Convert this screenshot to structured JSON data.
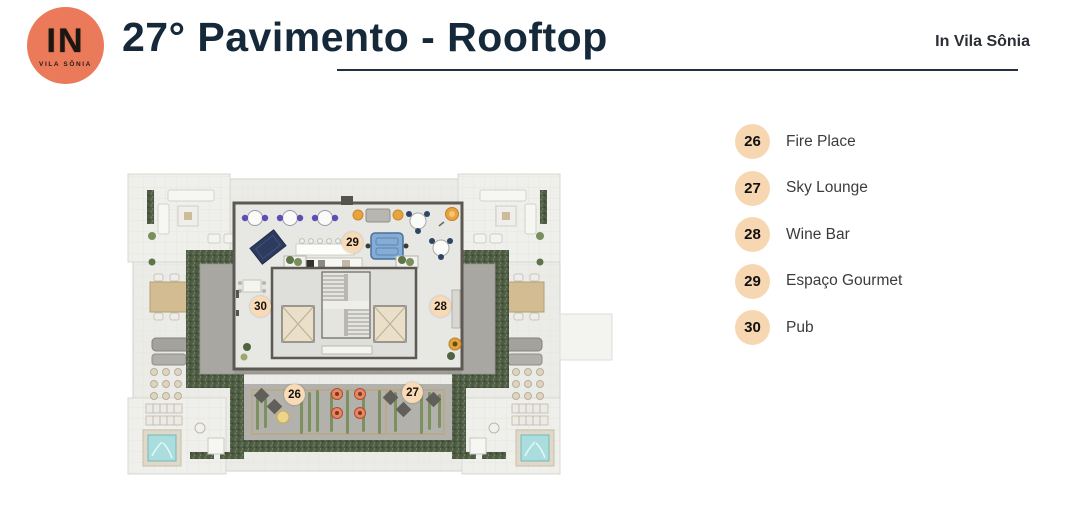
{
  "brand": {
    "logo_text": "IN",
    "logo_subtext": "VILA SÔNIA"
  },
  "header": {
    "title": "27° Pavimento - Rooftop",
    "right_label": "In Vila Sônia"
  },
  "legend": {
    "items": [
      {
        "number": "26",
        "label": "Fire Place"
      },
      {
        "number": "27",
        "label": "Sky Lounge"
      },
      {
        "number": "28",
        "label": "Wine Bar"
      },
      {
        "number": "29",
        "label": "Espaço Gourmet"
      },
      {
        "number": "30",
        "label": "Pub"
      }
    ]
  },
  "floor_plan": {
    "badges": [
      {
        "number": "26",
        "area": "Fire Place"
      },
      {
        "number": "27",
        "area": "Sky Lounge"
      },
      {
        "number": "28",
        "area": "Wine Bar"
      },
      {
        "number": "29",
        "area": "Espaço Gourmet"
      },
      {
        "number": "30",
        "area": "Pub"
      }
    ]
  },
  "colors": {
    "accent": "#eb7a5b",
    "title": "#15293b",
    "badge_bg": "#f7d7b2",
    "hedge_green": "#4e5b45",
    "deck_gray": "#a8a7a2",
    "sofa_blue": "#84acd4",
    "rug_navy": "#2d3b5e",
    "jacuzzi_water": "#aadddd"
  }
}
